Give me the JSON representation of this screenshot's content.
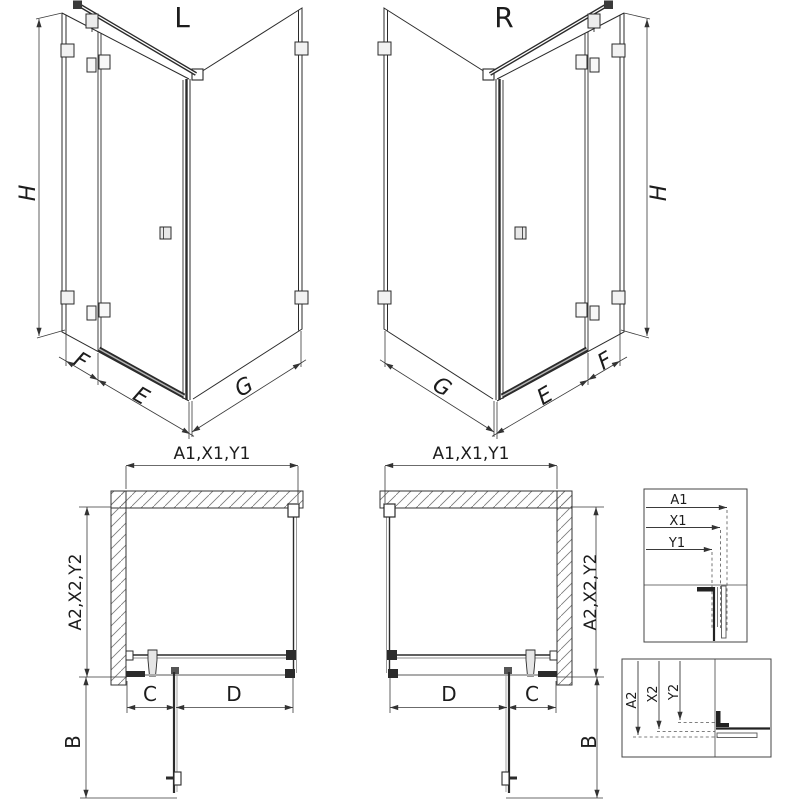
{
  "drawing": {
    "iso_left": {
      "title": "L",
      "height": "H",
      "panel_fixed": "F",
      "panel_door": "E",
      "panel_side": "G"
    },
    "iso_right": {
      "title": "R",
      "height": "H",
      "panel_fixed": "F",
      "panel_door": "E",
      "panel_side": "G"
    },
    "plan_left": {
      "width": "A1,X1,Y1",
      "depth": "A2,X2,Y2",
      "fixed": "C",
      "door": "D",
      "projection": "B"
    },
    "plan_right": {
      "width": "A1,X1,Y1",
      "depth": "A2,X2,Y2",
      "fixed": "C",
      "door": "D",
      "projection": "B"
    },
    "detail_width": {
      "l1": "A1",
      "l2": "X1",
      "l3": "Y1"
    },
    "detail_depth": {
      "l1": "A2",
      "l2": "X2",
      "l3": "Y2"
    },
    "colors": {
      "line": "#2b2b2b",
      "dim": "#3a3a3a",
      "gray": "#8f8f8f",
      "background": "#ffffff"
    }
  }
}
